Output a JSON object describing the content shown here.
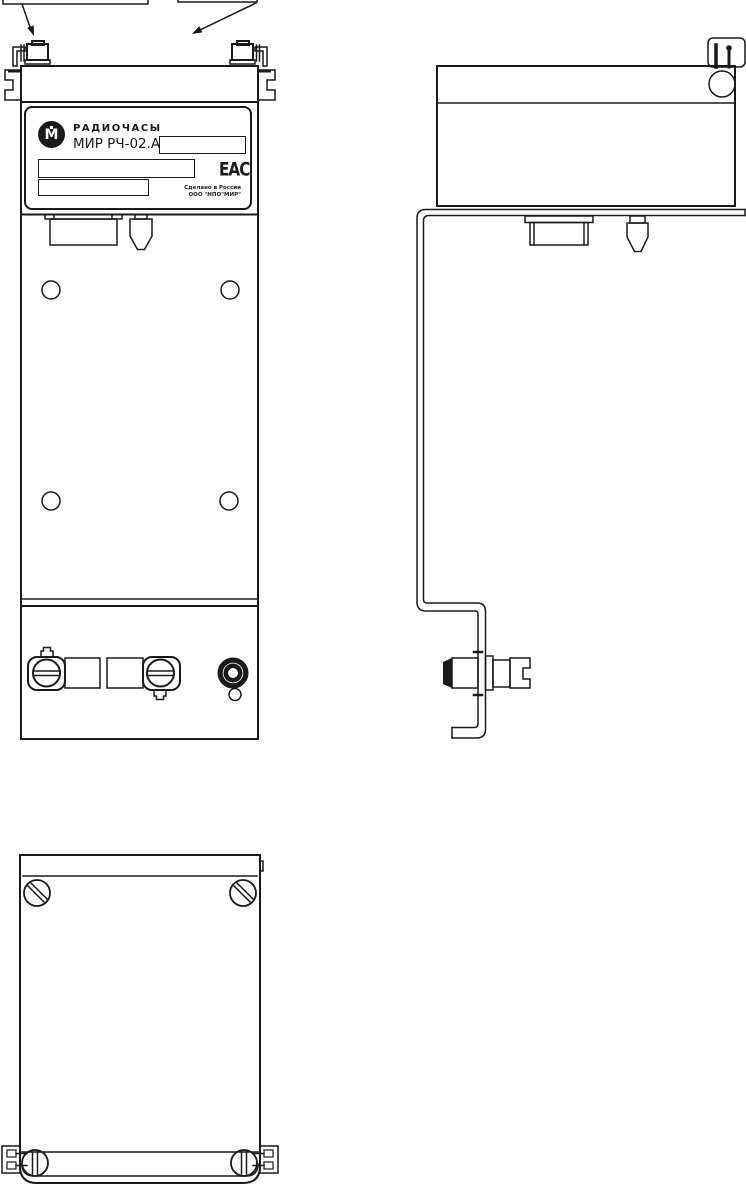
{
  "colors": {
    "line": "#1a1a1a",
    "background": "#ffffff"
  },
  "nameplate": {
    "logo_letter": "М",
    "product_type": "РАДИОЧАСЫ",
    "model": "МИР РЧ-02.А",
    "eac_mark": "ЕАС",
    "made_in": "Сделано в России",
    "manufacturer": "ООО \"НПО\"МИР\""
  }
}
